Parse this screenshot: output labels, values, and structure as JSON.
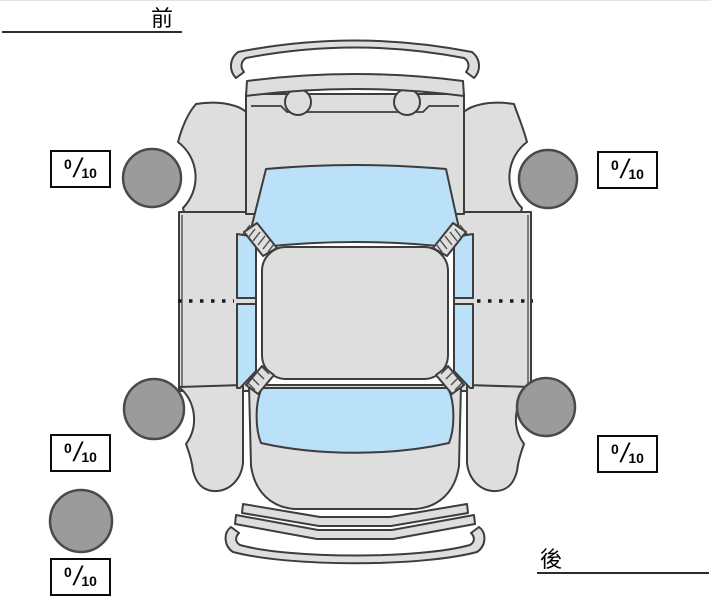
{
  "labels": {
    "front": "前",
    "rear": "後"
  },
  "ratings": {
    "front_left": {
      "value": "0",
      "slash": "/",
      "max": "10"
    },
    "front_right": {
      "value": "0",
      "slash": "/",
      "max": "10"
    },
    "rear_left": {
      "value": "0",
      "slash": "/",
      "max": "10"
    },
    "rear_right": {
      "value": "0",
      "slash": "/",
      "max": "10"
    },
    "spare": {
      "value": "0",
      "slash": "/",
      "max": "10"
    }
  },
  "diagram": {
    "kind": "car-top-view",
    "front_side": "top",
    "rear_side": "bottom",
    "tires": [
      "front-left",
      "front-right",
      "rear-left",
      "rear-right",
      "spare"
    ]
  },
  "colors": {
    "body": "#dedede",
    "window": "#bae1f7",
    "tire": "#9b9b9b",
    "outline": "#3d3d3d",
    "line": "#2b2b2b",
    "box_border": "#0a0a0a",
    "text": "#000000"
  }
}
